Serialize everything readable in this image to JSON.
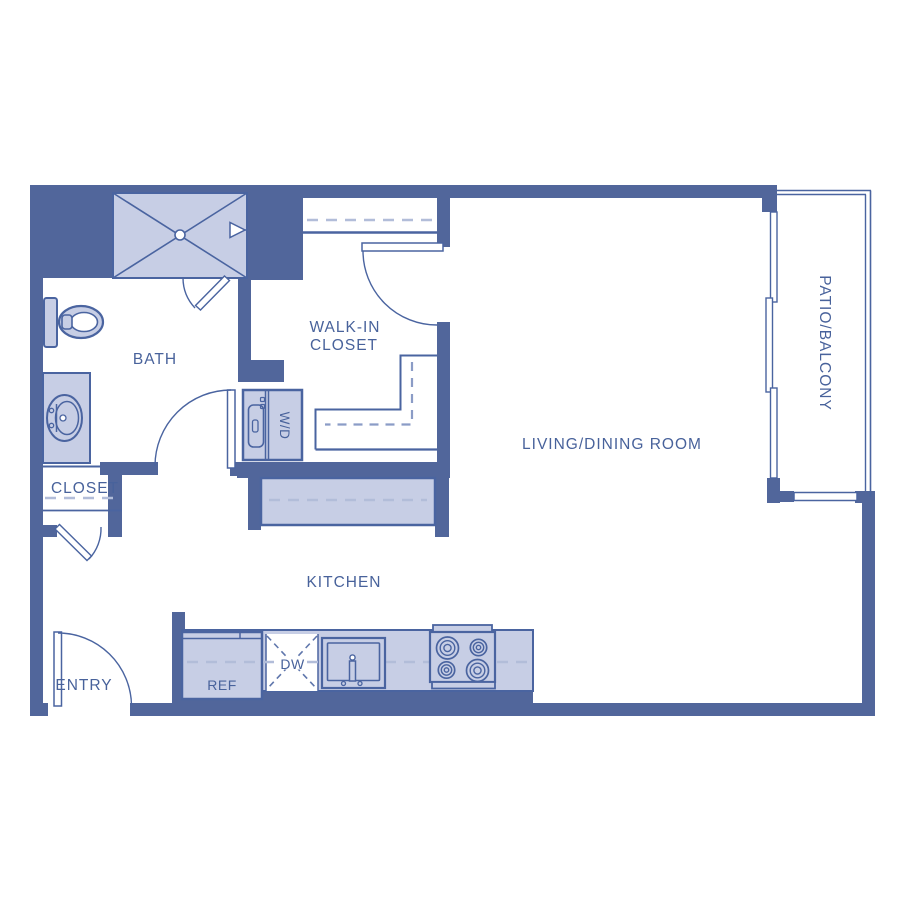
{
  "floorplan": {
    "colors": {
      "wall": "#51669B",
      "line": "#4A64A0",
      "fill": "#C7CEE5",
      "dash": "#B2BDD9",
      "dashmid": "#8B9CC6",
      "dashdark": "#5F76AC",
      "text": "#48629B",
      "bg": "#FFFFFF"
    },
    "rooms": {
      "bath": {
        "label": "BATH"
      },
      "walk_in_closet": {
        "label_line1": "WALK-IN",
        "label_line2": "CLOSET"
      },
      "living_dining": {
        "label": "LIVING/DINING ROOM"
      },
      "patio": {
        "label": "PATIO/BALCONY"
      },
      "closet": {
        "label": "CLOSET"
      },
      "entry": {
        "label": "ENTRY"
      },
      "kitchen": {
        "label": "KITCHEN"
      }
    },
    "appliances": {
      "washer_dryer": {
        "label": "W/D"
      },
      "refrigerator": {
        "label": "REF"
      },
      "dishwasher": {
        "label": "DW"
      }
    }
  }
}
